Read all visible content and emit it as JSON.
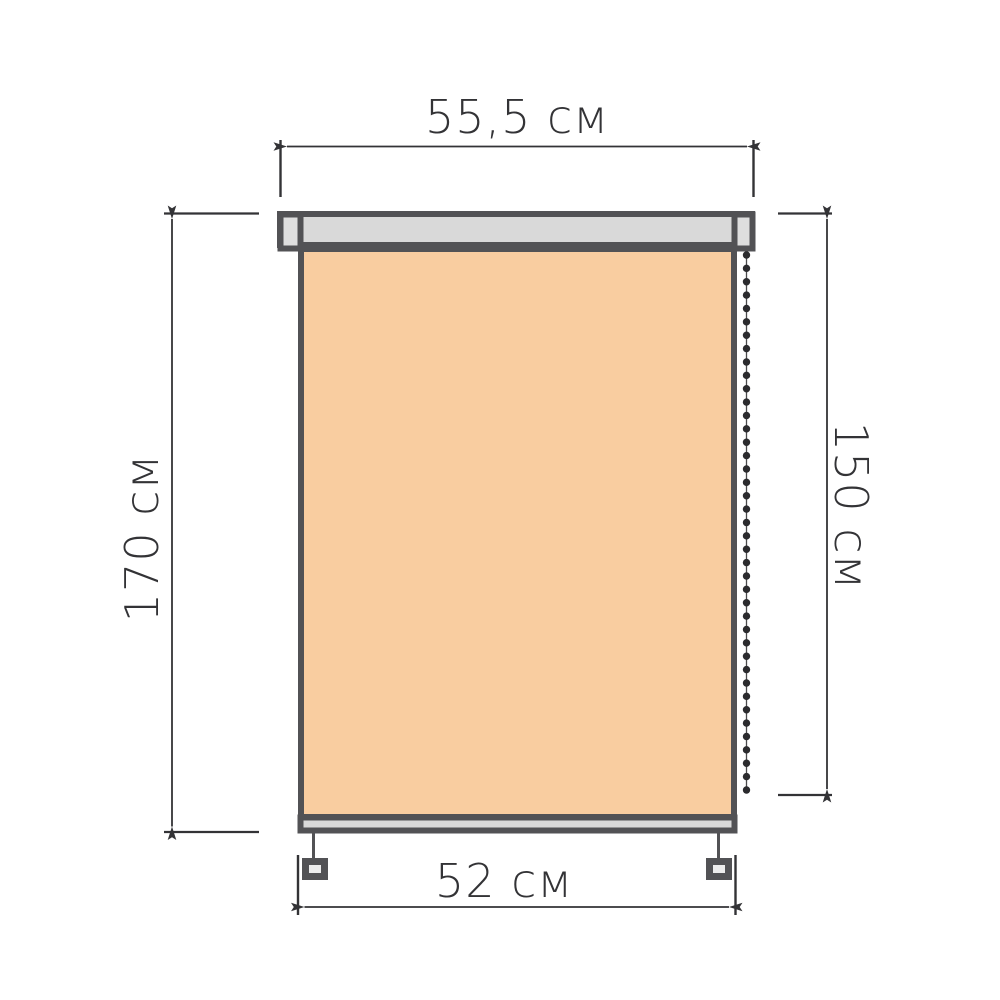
{
  "diagram": {
    "name": "roller-blind-dimension-diagram",
    "unit": "см",
    "dimensions": {
      "cassette_width": {
        "label": "55,5 см",
        "value": 55.5,
        "position": "top"
      },
      "total_height": {
        "label": "170 см",
        "value": 170,
        "position": "left"
      },
      "fabric_height": {
        "label": "150 см",
        "value": 150,
        "position": "right"
      },
      "fabric_width": {
        "label": "52 см",
        "value": 52,
        "position": "bottom"
      }
    },
    "chain": {
      "side": "right",
      "bead_count": 41
    },
    "colors": {
      "background": "#ffffff",
      "outline": "#525255",
      "cassette_fill": "#d9d9d9",
      "cap_fill": "#dedede",
      "fabric_fill": "#f9cda0",
      "rail_fill": "#d9d9d9",
      "bracket_fill": "#ececec",
      "dimension_color": "#333336",
      "bead_color": "#2b2b2e",
      "cord_color": "#4a4a4c"
    }
  }
}
